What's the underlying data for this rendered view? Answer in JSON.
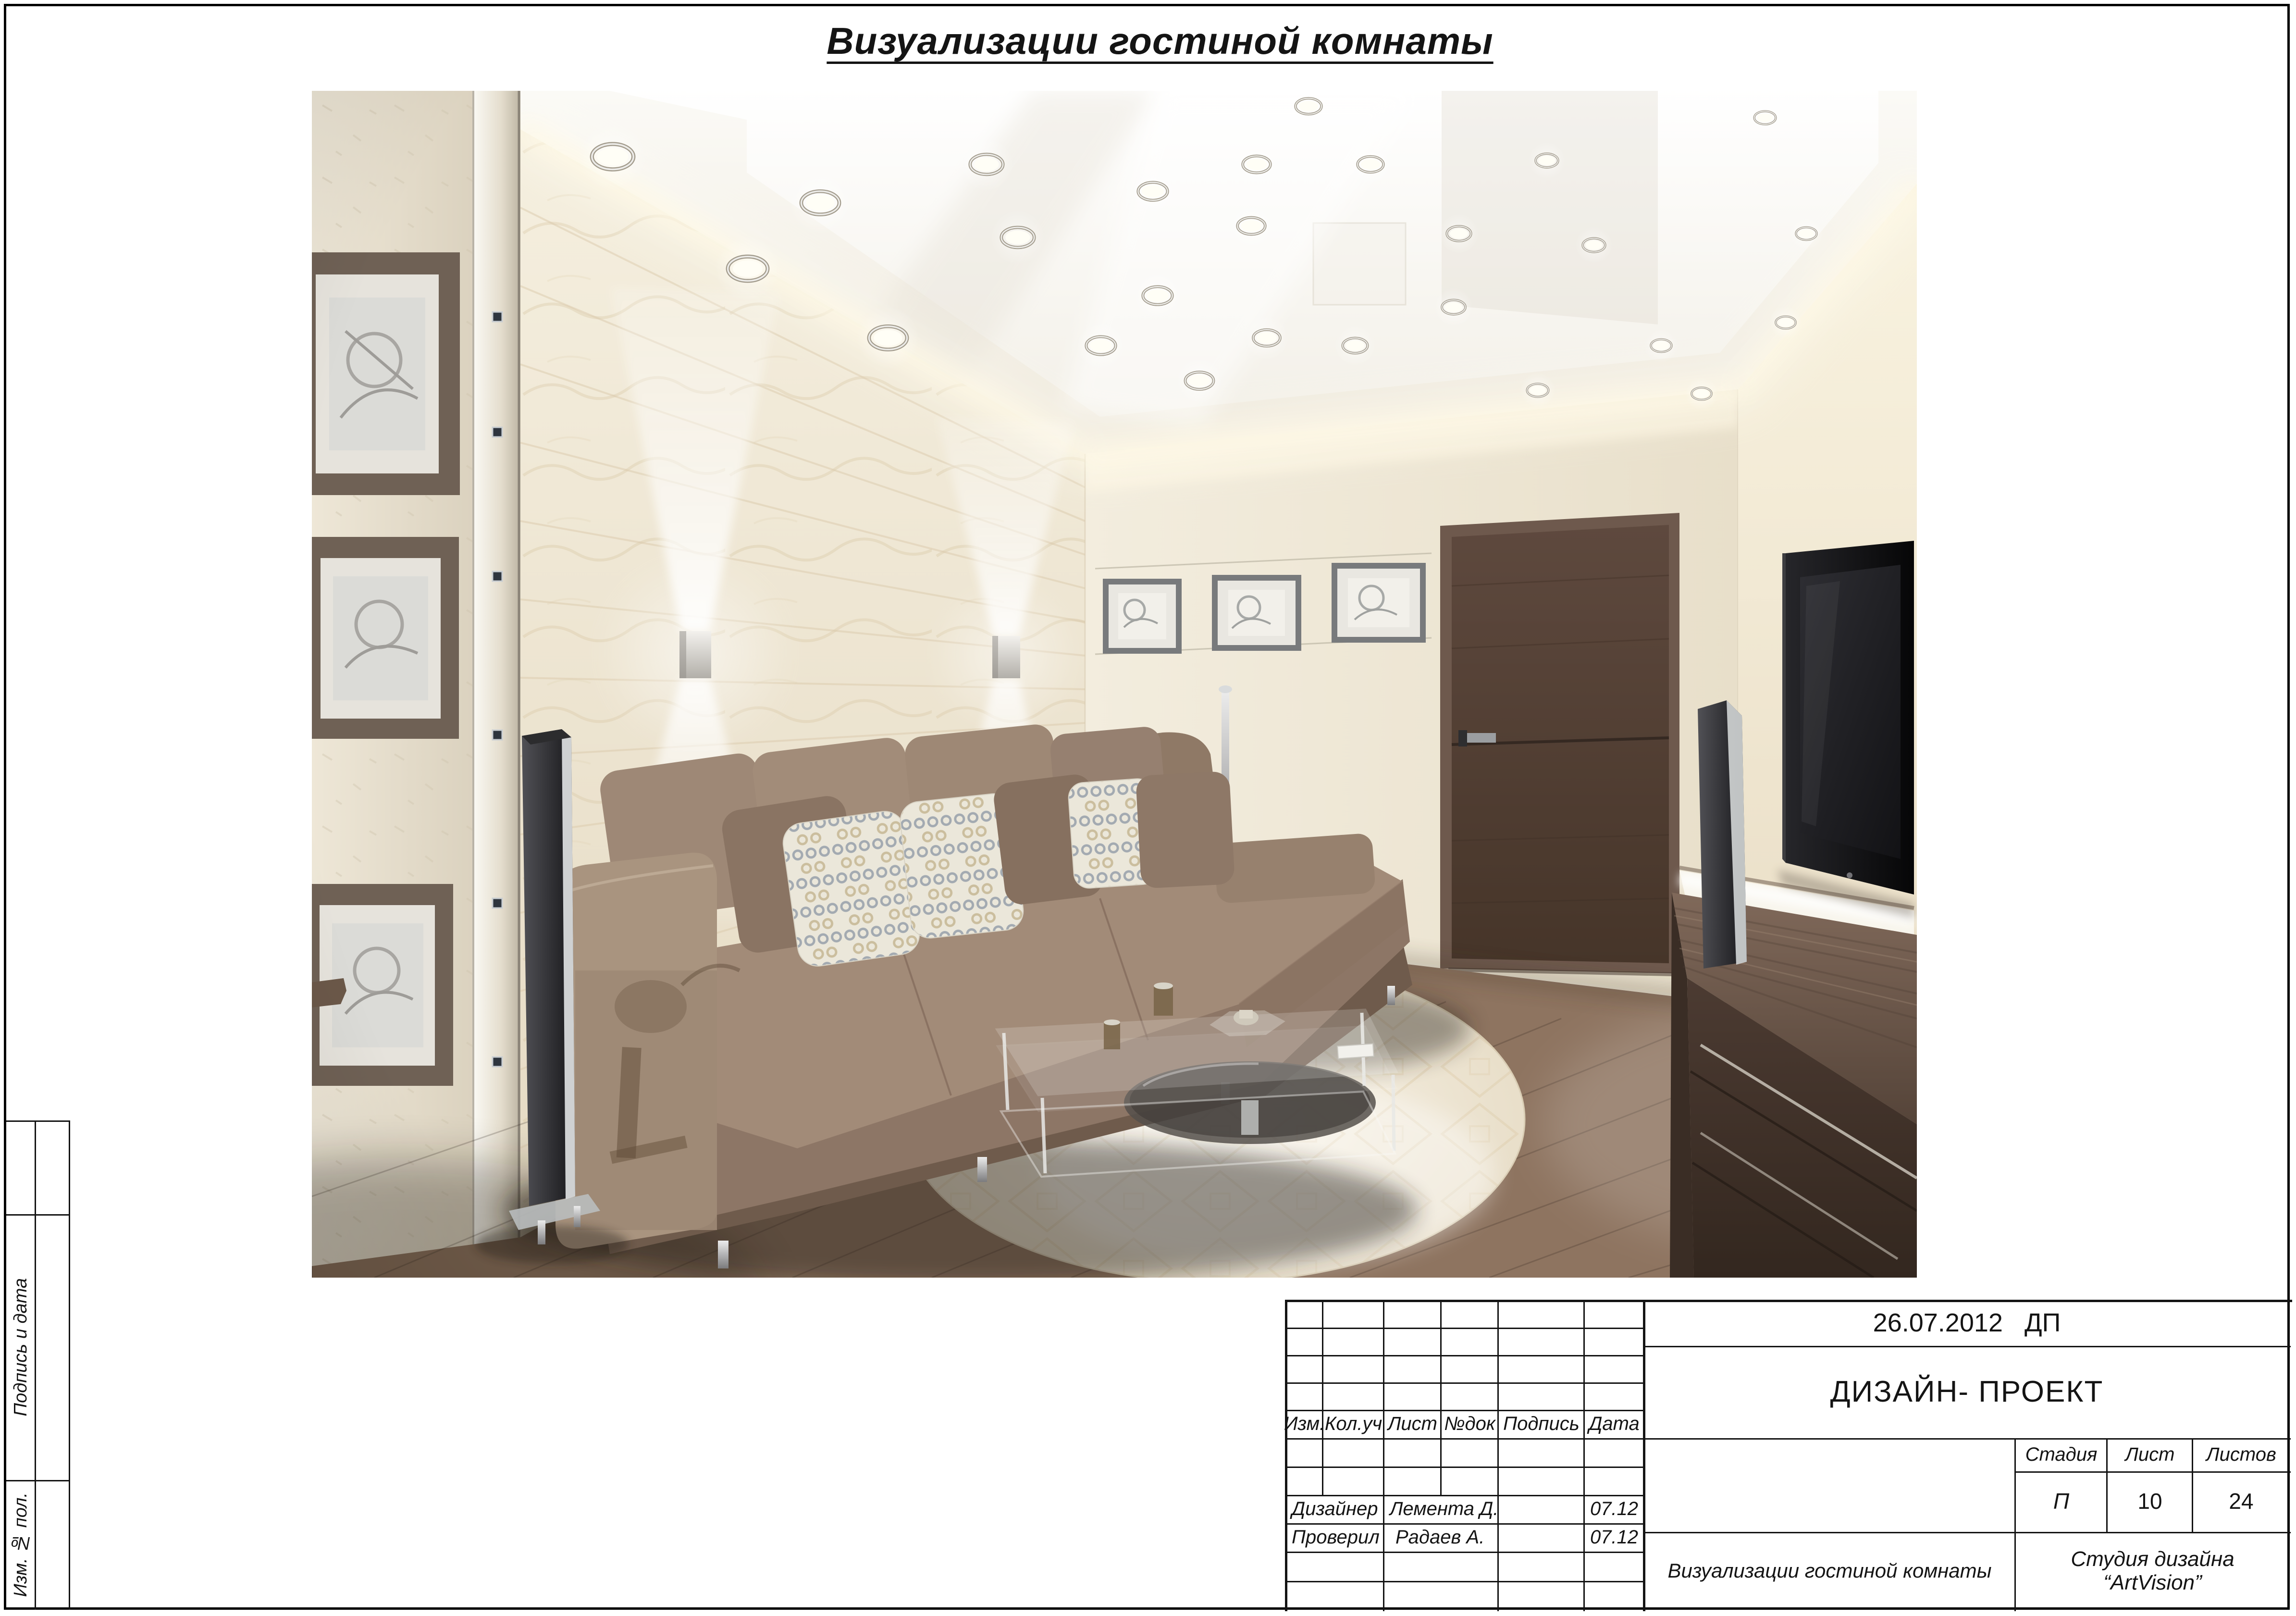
{
  "page": {
    "title": "Визуализации гостиной комнаты"
  },
  "side_strip": {
    "signature_label": "Подпись и дата",
    "inventory_label": "Изм. № пол."
  },
  "title_block": {
    "date_stamp": "26.07.2012   ДП",
    "doc_type": "ДИЗАЙН- ПРОЕКТ",
    "headers": {
      "izm": "Изм.",
      "kol": "Кол.уч",
      "list": "Лист",
      "ndok": "№док",
      "podpis": "Подпись",
      "data": "Дата"
    },
    "rows": [
      {
        "role": "Дизайнер",
        "name": "Лемента Д.",
        "date": "07.12"
      },
      {
        "role": "Проверил",
        "name": "Радаев А.",
        "date": "07.12"
      }
    ],
    "stage": {
      "stage_label": "Стадия",
      "sheet_label": "Лист",
      "sheets_label": "Листов",
      "stage_value": "П",
      "sheet_value": "10",
      "sheets_value": "24"
    },
    "sheet_name": "Визуализации гостиной комнаты",
    "studio_line1": "Студия дизайна",
    "studio_line2": "“ArtVision”"
  }
}
